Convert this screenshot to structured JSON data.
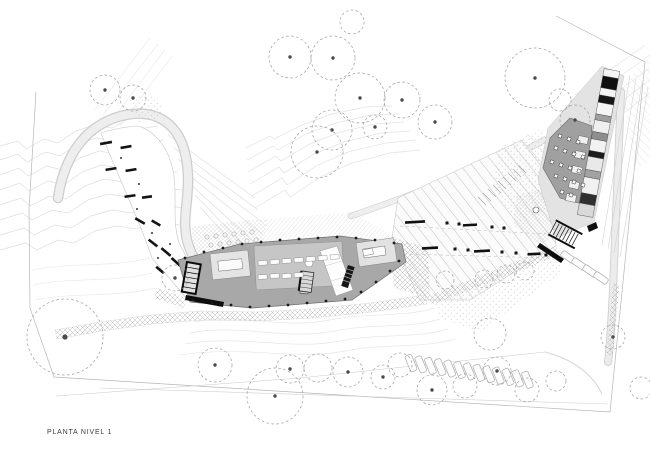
{
  "title_label": "PLANTA NIVEL 1",
  "palette": {
    "bg": "#ffffff",
    "ink": "#141414",
    "contour": "#dedede",
    "contour_faint": "#ebebeb",
    "boundary": "#b6b6b6",
    "road_edge": "#cdcdcd",
    "road_fill": "#eeeeee",
    "building": "#a8a8a8",
    "building_edge": "#6f6f6f",
    "room_light": "#e4e4e4",
    "room_mid": "#c6c6c6",
    "terrace": "#a0a0a0",
    "stripe": "#c5c5c5",
    "tree": "#9c9c9c",
    "trunk": "#4a4a4a",
    "stall": "#b2b2b2",
    "hatch": "#b3b3b3"
  },
  "trees": [
    [
      105,
      90,
      15,
      1
    ],
    [
      133,
      98,
      13,
      1
    ],
    [
      290,
      57,
      21,
      1
    ],
    [
      333,
      58,
      22,
      1
    ],
    [
      360,
      98,
      25,
      1
    ],
    [
      402,
      100,
      18,
      1
    ],
    [
      332,
      130,
      20,
      1
    ],
    [
      317,
      152,
      26,
      1
    ],
    [
      375,
      127,
      12,
      1
    ],
    [
      352,
      22,
      12,
      0
    ],
    [
      435,
      122,
      17,
      1
    ],
    [
      535,
      78,
      30,
      1
    ],
    [
      575,
      120,
      15,
      1
    ],
    [
      560,
      100,
      11,
      0
    ],
    [
      175,
      278,
      13,
      1
    ],
    [
      65,
      337,
      38,
      1
    ],
    [
      215,
      365,
      17,
      1
    ],
    [
      290,
      369,
      14,
      1
    ],
    [
      318,
      368,
      14,
      0
    ],
    [
      348,
      372,
      15,
      1
    ],
    [
      383,
      377,
      12,
      1
    ],
    [
      275,
      396,
      28,
      1
    ],
    [
      445,
      280,
      9,
      0
    ],
    [
      484,
      279,
      9,
      0
    ],
    [
      506,
      274,
      9,
      0
    ],
    [
      525,
      271,
      9,
      0
    ],
    [
      400,
      365,
      12,
      0
    ],
    [
      432,
      390,
      15,
      1
    ],
    [
      465,
      386,
      12,
      0
    ],
    [
      497,
      371,
      14,
      1
    ],
    [
      527,
      390,
      12,
      0
    ],
    [
      556,
      381,
      10,
      0
    ],
    [
      613,
      337,
      12,
      1
    ],
    [
      641,
      388,
      11,
      0
    ],
    [
      490,
      334,
      16,
      0
    ]
  ],
  "left_plaza": {
    "bars": [
      [
        106,
        143,
        12,
        -10
      ],
      [
        126,
        147,
        11,
        -10
      ],
      [
        111,
        169,
        11,
        -9
      ],
      [
        131,
        170,
        11,
        -9
      ],
      [
        130,
        196,
        11,
        -8
      ],
      [
        147,
        197,
        10,
        -8
      ],
      [
        140,
        221,
        11,
        30
      ],
      [
        156,
        223,
        10,
        30
      ],
      [
        153,
        243,
        11,
        38
      ],
      [
        166,
        252,
        12,
        40
      ],
      [
        176,
        262,
        12,
        42
      ],
      [
        160,
        270,
        10,
        40
      ]
    ],
    "dots": [
      [
        121,
        158
      ],
      [
        139,
        184
      ],
      [
        137,
        209
      ],
      [
        152,
        233
      ],
      [
        158,
        258
      ],
      [
        170,
        244
      ]
    ]
  },
  "central_building": {
    "columns": [
      [
        185,
        258
      ],
      [
        204,
        252
      ],
      [
        223,
        248
      ],
      [
        242,
        244
      ],
      [
        261,
        242
      ],
      [
        280,
        240
      ],
      [
        299,
        239
      ],
      [
        318,
        238
      ],
      [
        337,
        237
      ],
      [
        356,
        238
      ],
      [
        375,
        240
      ],
      [
        394,
        243
      ],
      [
        193,
        300
      ],
      [
        212,
        303
      ],
      [
        231,
        305
      ],
      [
        250,
        307
      ],
      [
        269,
        306
      ],
      [
        288,
        305
      ],
      [
        307,
        303
      ],
      [
        326,
        301
      ],
      [
        345,
        299
      ],
      [
        361,
        292
      ],
      [
        376,
        282
      ],
      [
        390,
        271
      ],
      [
        399,
        261
      ]
    ],
    "desks": [
      [
        258,
        261
      ],
      [
        270,
        260
      ],
      [
        282,
        259
      ],
      [
        294,
        258
      ],
      [
        306,
        257
      ],
      [
        318,
        256
      ],
      [
        330,
        255
      ],
      [
        258,
        275
      ],
      [
        270,
        274
      ],
      [
        282,
        274
      ],
      [
        294,
        273
      ]
    ],
    "table_grid": [
      [
        207,
        237
      ],
      [
        216,
        236
      ],
      [
        225,
        235
      ],
      [
        234,
        234
      ],
      [
        243,
        233
      ],
      [
        252,
        232
      ],
      [
        211,
        245
      ],
      [
        220,
        244
      ],
      [
        229,
        243
      ],
      [
        238,
        242
      ],
      [
        247,
        241
      ],
      [
        256,
        240
      ]
    ]
  },
  "striped_plaza": {
    "benches": [
      [
        415,
        222,
        20,
        -3
      ],
      [
        470,
        225,
        14,
        -3
      ],
      [
        430,
        248,
        16,
        -3
      ],
      [
        482,
        251,
        16,
        -3
      ],
      [
        534,
        254,
        13,
        -3
      ]
    ],
    "squares": [
      [
        447,
        223
      ],
      [
        459,
        224
      ],
      [
        492,
        227
      ],
      [
        504,
        228
      ],
      [
        455,
        249
      ],
      [
        468,
        250
      ],
      [
        502,
        252
      ],
      [
        516,
        253
      ],
      [
        546,
        255
      ]
    ]
  },
  "terrace": {
    "tables": [
      [
        560,
        136
      ],
      [
        569,
        139
      ],
      [
        578,
        142
      ],
      [
        556,
        148
      ],
      [
        565,
        151
      ],
      [
        574,
        154
      ],
      [
        583,
        157
      ],
      [
        552,
        162
      ],
      [
        561,
        165
      ],
      [
        570,
        168
      ],
      [
        579,
        171
      ],
      [
        556,
        176
      ],
      [
        565,
        179
      ],
      [
        574,
        182
      ],
      [
        583,
        185
      ],
      [
        562,
        192
      ],
      [
        571,
        195
      ]
    ]
  },
  "right_bar": {
    "axis_a": [
      612,
      70
    ],
    "axis_b": [
      585,
      216
    ],
    "halfwidth": 7.9,
    "cells": [
      [
        0.0,
        0.05,
        "#f4f4f4"
      ],
      [
        0.05,
        0.13,
        "#101010"
      ],
      [
        0.13,
        0.18,
        "#f4f4f4"
      ],
      [
        0.18,
        0.23,
        "#161616"
      ],
      [
        0.23,
        0.31,
        "#f6f6f6"
      ],
      [
        0.31,
        0.35,
        "#9f9f9f"
      ],
      [
        0.35,
        0.43,
        "#efefef"
      ],
      [
        0.43,
        0.48,
        "#8e8e8e"
      ],
      [
        0.48,
        0.56,
        "#f2f2f2"
      ],
      [
        0.56,
        0.6,
        "#1c1c1c"
      ],
      [
        0.6,
        0.69,
        "#e9e9e9"
      ],
      [
        0.69,
        0.74,
        "#a2a2a2"
      ],
      [
        0.74,
        0.85,
        "#f1f1f1"
      ],
      [
        0.85,
        0.92,
        "#303030"
      ],
      [
        0.92,
        1.0,
        "#d9d9d9"
      ]
    ],
    "annex_rooms": [
      [
        583,
        140
      ],
      [
        580,
        155
      ],
      [
        577,
        170
      ],
      [
        574,
        185
      ],
      [
        571,
        198
      ]
    ]
  },
  "parking_main": {
    "count": 13,
    "start": [
      411,
      363
    ],
    "step": [
      9.7,
      1.4
    ],
    "angle": -22,
    "w": 7,
    "h": 17
  },
  "parking_upper": {
    "stalls": [
      [
        568,
        257
      ],
      [
        579,
        264
      ],
      [
        590,
        271
      ],
      [
        601,
        278
      ]
    ],
    "angle": -55,
    "w": 6.5,
    "h": 15
  }
}
